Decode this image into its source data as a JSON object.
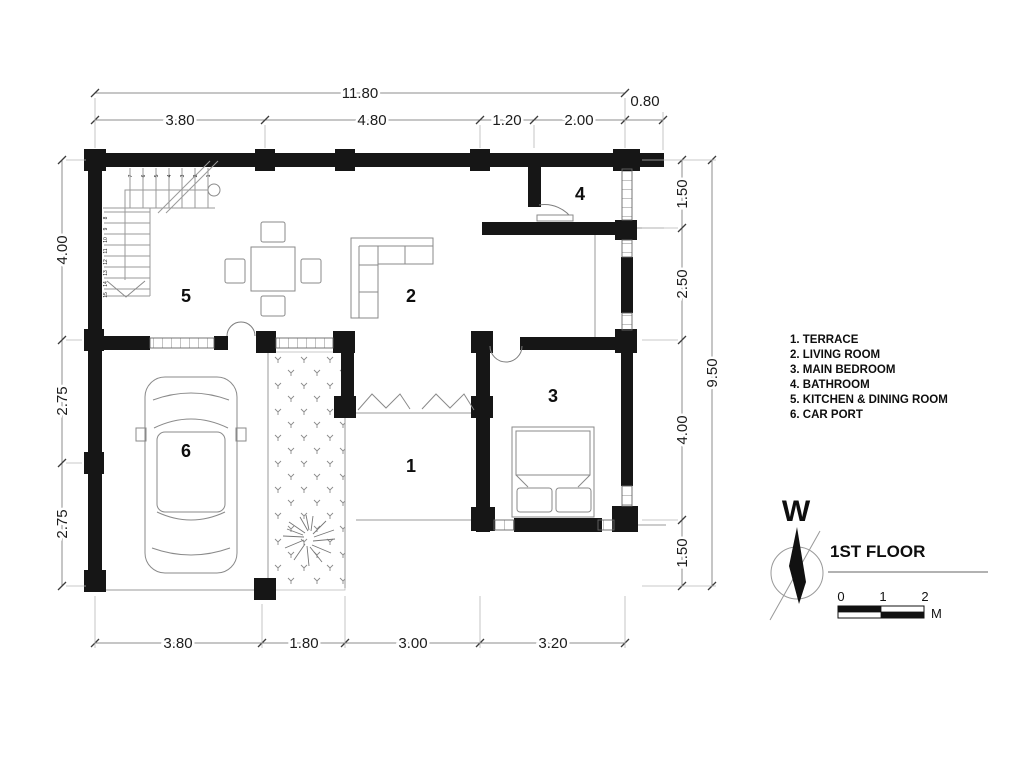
{
  "title": "1ST FLOOR",
  "compass_letter": "W",
  "scale": {
    "t0": "0",
    "t1": "1",
    "t2": "2",
    "unit": "M"
  },
  "legend": [
    "1. TERRACE",
    "2. LIVING ROOM",
    "3. MAIN BEDROOM",
    "4. BATHROOM",
    "5. KITCHEN & DINING ROOM",
    "6. CAR PORT"
  ],
  "rooms": {
    "terrace": "1",
    "living": "2",
    "bedroom": "3",
    "bath": "4",
    "kitchen": "5",
    "carport": "6"
  },
  "dims": {
    "top_total": "11.80",
    "top_ext": "0.80",
    "top_row": [
      "3.80",
      "4.80",
      "1.20",
      "2.00"
    ],
    "left": [
      "4.00",
      "2.75",
      "2.75"
    ],
    "right": [
      "1.50",
      "2.50",
      "4.00",
      "1.50"
    ],
    "right_total": "9.50",
    "bottom": [
      "3.80",
      "1.80",
      "3.00",
      "3.20"
    ]
  },
  "stairs": {
    "up": [
      "1",
      "2",
      "3",
      "4",
      "5",
      "6",
      "7"
    ],
    "side": [
      "8",
      "9",
      "10",
      "11",
      "12",
      "13",
      "14",
      "15"
    ]
  },
  "colors": {
    "wall": "#161616",
    "line": "#8a8a8a",
    "text": "#1a1a1a"
  }
}
